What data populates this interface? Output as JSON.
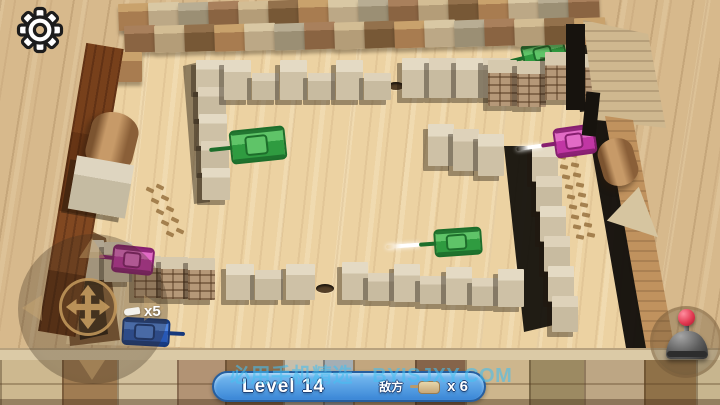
{
  "hud": {
    "level_label": "Level 14",
    "enemy_label": "敌方",
    "enemy_count": "x 6",
    "lives": "x5",
    "watermark": "必用手机精选 · BYISJXY.COM",
    "colors": {
      "bar_top": "#7abef2",
      "bar_bottom": "#3a86d6",
      "bar_border": "#265e9e",
      "watermark": "rgba(70,190,240,0.60)",
      "joystick_accent": "#c49a5e",
      "fire_knob": "#d62e44",
      "tank_green": "#2f9b40",
      "tank_purple": "#c136a4",
      "tank_blue": "#2758b6"
    }
  },
  "scene": {
    "palettes": {
      "outer": [
        [
          "#c9a26c",
          "#a87c50"
        ],
        [
          "#d9c8a4",
          "#bca886"
        ],
        [
          "#b8ad93",
          "#9b8f74"
        ],
        [
          "#a9805c",
          "#8a6442"
        ],
        [
          "#d3bd94",
          "#b49d78"
        ],
        [
          "#93714c",
          "#775836"
        ]
      ],
      "outer2": [
        [
          "#a9805c",
          "#8a6442"
        ],
        [
          "#d3bd94",
          "#b49d78"
        ],
        [
          "#93714c",
          "#775836"
        ],
        [
          "#c9a26c",
          "#a87c50"
        ],
        [
          "#d9c8a4",
          "#bca886"
        ],
        [
          "#b8ad93",
          "#9b8f74"
        ]
      ],
      "plain": [
        [
          "#e4dac4",
          "#cec1a6"
        ],
        [
          "#ded2ba",
          "#c8bba0"
        ]
      ],
      "brickpal": [
        [
          "#d6c9ae",
          "#b59878"
        ]
      ]
    },
    "walls": [
      {
        "x": 118,
        "y": 4,
        "count": 16,
        "sx": 30,
        "sy": 0.4,
        "w": 31,
        "h": 27,
        "pal": "outer",
        "rot": -2,
        "flat": true
      },
      {
        "x": 124,
        "y": 26,
        "count": 16,
        "sx": 30,
        "sy": 0.5,
        "w": 31,
        "h": 27,
        "pal": "outer2",
        "rot": -2,
        "flat": true
      },
      {
        "x": 112,
        "y": 52,
        "count": 1,
        "sx": 0,
        "sy": 0,
        "w": 30,
        "h": 30,
        "pal": "outer",
        "flat": true
      },
      {
        "x": 196,
        "y": 60,
        "count": 5,
        "sx": 1.5,
        "sy": 27,
        "w": 28,
        "h": 32,
        "pal": "plain"
      },
      {
        "x": 224,
        "y": 60,
        "count": 6,
        "sx": 28,
        "sy": 0,
        "w": 27,
        "h": 40,
        "hs": [
          40,
          27
        ],
        "pal": "plain"
      },
      {
        "x": 402,
        "y": 58,
        "count": 2,
        "sx": 27,
        "sy": 0,
        "w": 27,
        "h": 40,
        "pal": "plain"
      },
      {
        "x": 456,
        "y": 58,
        "count": 2,
        "sx": 27,
        "sy": 0,
        "w": 27,
        "h": 40,
        "pal": "plain"
      },
      {
        "x": 488,
        "y": 60,
        "count": 2,
        "sx": 29,
        "sy": 1,
        "w": 29,
        "h": 46,
        "pal": "brickpal",
        "brick": true
      },
      {
        "x": 545,
        "y": 52,
        "count": 2,
        "sx": 28,
        "sy": 2,
        "w": 28,
        "h": 48,
        "pal": "brickpal",
        "brick": true
      },
      {
        "x": 428,
        "y": 124,
        "count": 3,
        "sx": 25,
        "sy": 5,
        "w": 26,
        "h": 42,
        "pal": "plain"
      },
      {
        "x": 532,
        "y": 146,
        "count": 6,
        "sx": 4,
        "sy": 30,
        "w": 26,
        "h": 36,
        "pal": "plain"
      },
      {
        "x": 76,
        "y": 240,
        "count": 2,
        "sx": 28,
        "sy": 2,
        "w": 28,
        "h": 40,
        "pal": "plain"
      },
      {
        "x": 134,
        "y": 256,
        "count": 3,
        "sx": 27,
        "sy": 1,
        "w": 27,
        "h": 42,
        "pal": "brickpal",
        "brick": true
      },
      {
        "x": 226,
        "y": 264,
        "count": 2,
        "sx": 29,
        "sy": 0,
        "w": 28,
        "h": 36,
        "hs": [
          36,
          30
        ],
        "pal": "plain"
      },
      {
        "x": 286,
        "y": 264,
        "count": 1,
        "sx": 0,
        "sy": 0,
        "w": 29,
        "h": 36,
        "pal": "plain"
      },
      {
        "x": 342,
        "y": 262,
        "count": 7,
        "sx": 26,
        "sy": 1.2,
        "w": 26,
        "h": 38,
        "hs": [
          38,
          28
        ],
        "pal": "plain"
      }
    ],
    "shadows": [
      {
        "pts": "565px 24px,586px 26px,598px 110px,580px 112px",
        "c": "rgba(22,18,12,0.93)",
        "z": 14
      },
      {
        "pts": "585px 110px,608px 112px,656px 366px,630px 371px",
        "c": "rgba(16,13,9,0.95)",
        "z": 14
      },
      {
        "pts": "504px 146px,534px 146px,558px 324px,524px 332px",
        "c": "rgba(14,12,8,0.92)",
        "z": 14
      },
      {
        "pts": "183px 66px,199px 62px,210px 202px,194px 204px",
        "c": "rgba(30,22,12,0.45)",
        "z": 13
      },
      {
        "pts": "74px 250px,100px 260px,108px 334px,80px 340px",
        "c": "rgba(24,17,10,0.80)",
        "z": 14
      },
      {
        "pts": "60px 216px,106px 238px,120px 340px,70px 346px",
        "c": "rgba(122,85,51,0.95)",
        "z": 13
      }
    ],
    "holes": [
      {
        "x": 388,
        "y": 82,
        "w": 16,
        "h": 8
      },
      {
        "x": 426,
        "y": 82,
        "w": 16,
        "h": 8
      },
      {
        "x": 433,
        "y": 60,
        "w": 11,
        "h": 6
      },
      {
        "x": 316,
        "y": 284,
        "w": 18,
        "h": 9
      }
    ],
    "trails": [
      {
        "x": 146,
        "y": 188,
        "sx": 5,
        "sy": 11,
        "count": 5,
        "gx": 10,
        "gy": -3,
        "rot": 25
      },
      {
        "x": 558,
        "y": 155,
        "sx": 2.2,
        "sy": 10,
        "count": 9,
        "gx": 11,
        "gy": -2,
        "rot": 12
      }
    ],
    "tank_colors": {
      "green": {
        "lt": "#5fc468",
        "bd": "#2f9b40",
        "dk": "#1d6e2b"
      },
      "purple": {
        "lt": "#e26bc6",
        "bd": "#c136a4",
        "dk": "#871f70"
      },
      "blue": {
        "lt": "#4f85e0",
        "bd": "#2758b6",
        "dk": "#16387c"
      }
    },
    "tanks": [
      {
        "name": "enemy-tank-green-1",
        "type": "green",
        "x": 230,
        "y": 128,
        "w": 56,
        "h": 34,
        "rot": -6,
        "barrel": "left",
        "bl": 24,
        "z": 22
      },
      {
        "name": "enemy-tank-green-2",
        "type": "green",
        "x": 522,
        "y": 40,
        "w": 44,
        "h": 26,
        "rot": -14,
        "barrel": "left",
        "bl": 16,
        "z": 19
      },
      {
        "name": "enemy-tank-purple-1",
        "type": "purple",
        "x": 554,
        "y": 126,
        "w": 42,
        "h": 30,
        "rot": -8,
        "barrel": "left",
        "bl": 16,
        "flash": 26,
        "z": 22
      },
      {
        "name": "enemy-tank-green-3",
        "type": "green",
        "x": 434,
        "y": 228,
        "w": 48,
        "h": 28,
        "rot": -4,
        "barrel": "left",
        "bl": 18,
        "flash": 34,
        "z": 22
      },
      {
        "name": "enemy-tank-purple-2",
        "type": "purple",
        "x": 112,
        "y": 246,
        "w": 42,
        "h": 28,
        "rot": 6,
        "barrel": "left",
        "bl": 16,
        "z": 22
      },
      {
        "name": "player-tank",
        "type": "blue",
        "x": 122,
        "y": 318,
        "w": 48,
        "h": 28,
        "rot": 3,
        "barrel": "right",
        "bl": 18,
        "z": 28
      }
    ],
    "bottom_planks": [
      {
        "w": 62,
        "c": "#cdb88f"
      },
      {
        "w": 55,
        "c": "#a07c52"
      },
      {
        "w": 60,
        "c": "#d2c09c"
      },
      {
        "w": 48,
        "c": "#b29374"
      },
      {
        "w": 58,
        "c": "#8d6c49"
      },
      {
        "w": 40,
        "c": "#c8bfab"
      },
      {
        "w": 30,
        "c": "#a4aeb4"
      },
      {
        "w": 62,
        "c": "#c2a67e"
      },
      {
        "w": 50,
        "c": "#85644a"
      },
      {
        "w": 64,
        "c": "#cdb68d"
      },
      {
        "w": 55,
        "c": "#9c8a62"
      },
      {
        "w": 60,
        "c": "#bda684"
      },
      {
        "w": 52,
        "c": "#8f7148"
      },
      {
        "w": 40,
        "c": "#c7b58e"
      }
    ]
  }
}
